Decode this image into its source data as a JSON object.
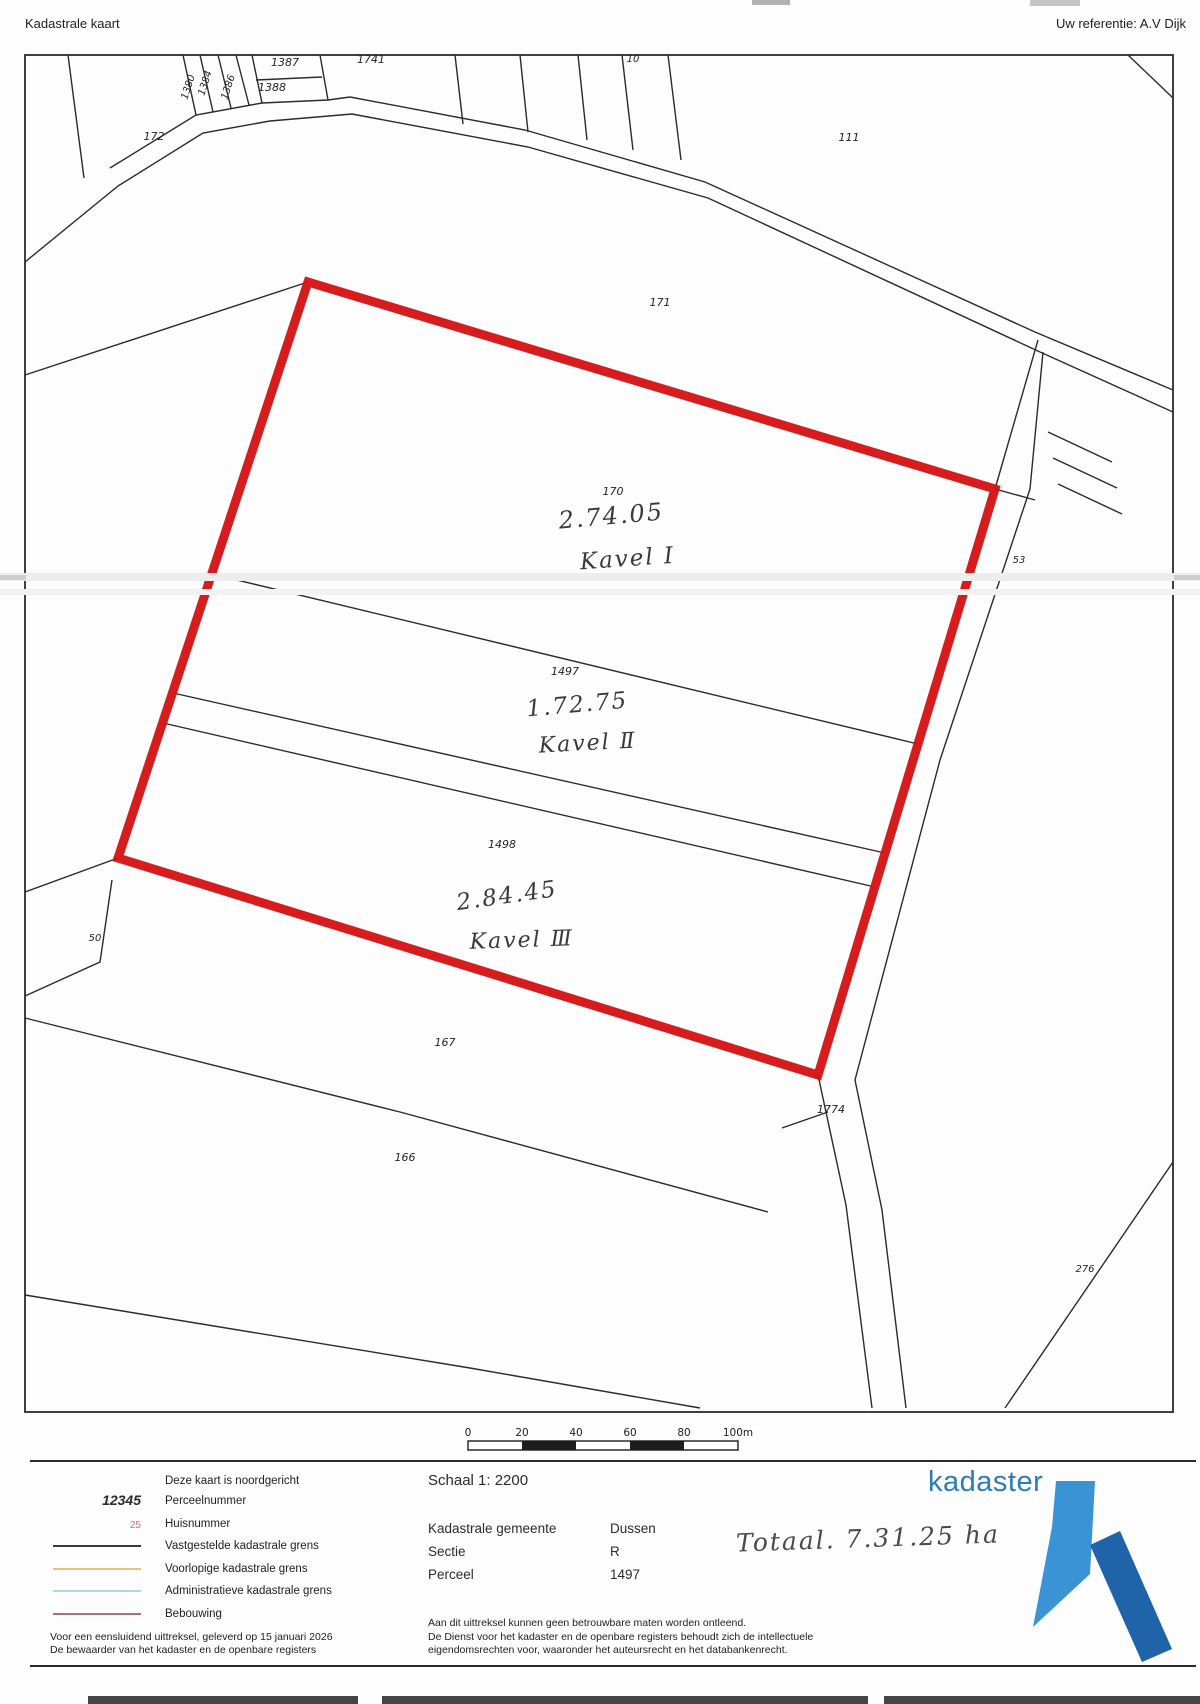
{
  "header": {
    "title": "Kadastrale kaart",
    "reference": "Uw referentie: A.V Dijk"
  },
  "map": {
    "frame": {
      "x": 25,
      "y": 55,
      "w": 1148,
      "h": 1357
    },
    "line_color": "#2b2b2b",
    "red_color": "#d41010",
    "red_outline": [
      [
        308,
        282
      ],
      [
        995,
        489
      ],
      [
        818,
        1075
      ],
      [
        118,
        858
      ]
    ],
    "lines": [
      [
        [
          68,
          55
        ],
        [
          84,
          178
        ]
      ],
      [
        [
          183,
          55
        ],
        [
          196,
          115
        ]
      ],
      [
        [
          200,
          55
        ],
        [
          213,
          112
        ]
      ],
      [
        [
          218,
          55
        ],
        [
          231,
          108
        ]
      ],
      [
        [
          236,
          55
        ],
        [
          249,
          105
        ]
      ],
      [
        [
          252,
          55
        ],
        [
          262,
          103
        ]
      ],
      [
        [
          320,
          55
        ],
        [
          328,
          100
        ]
      ],
      [
        [
          256,
          80
        ],
        [
          322,
          77
        ]
      ],
      [
        [
          110,
          168
        ],
        [
          196,
          115
        ],
        [
          262,
          103
        ],
        [
          328,
          100
        ],
        [
          350,
          97
        ]
      ],
      [
        [
          455,
          55
        ],
        [
          463,
          124
        ]
      ],
      [
        [
          520,
          55
        ],
        [
          528,
          132
        ]
      ],
      [
        [
          578,
          55
        ],
        [
          587,
          140
        ]
      ],
      [
        [
          622,
          55
        ],
        [
          633,
          150
        ]
      ],
      [
        [
          668,
          55
        ],
        [
          681,
          160
        ]
      ],
      [
        [
          350,
          97
        ],
        [
          525,
          130
        ],
        [
          705,
          182
        ],
        [
          1035,
          332
        ]
      ],
      [
        [
          118,
          186
        ],
        [
          203,
          133
        ],
        [
          270,
          121
        ],
        [
          352,
          114
        ],
        [
          528,
          147
        ],
        [
          708,
          198
        ],
        [
          1040,
          352
        ]
      ],
      [
        [
          25,
          262
        ],
        [
          118,
          186
        ]
      ],
      [
        [
          25,
          375
        ],
        [
          308,
          282
        ]
      ],
      [
        [
          1038,
          340
        ],
        [
          995,
          489
        ]
      ],
      [
        [
          995,
          489
        ],
        [
          1035,
          500
        ]
      ],
      [
        [
          212,
          574
        ],
        [
          918,
          744
        ]
      ],
      [
        [
          173,
          693
        ],
        [
          885,
          853
        ]
      ],
      [
        [
          163,
          723
        ],
        [
          875,
          887
        ]
      ],
      [
        [
          118,
          858
        ],
        [
          25,
          892
        ]
      ],
      [
        [
          112,
          880
        ],
        [
          100,
          962
        ],
        [
          25,
          996
        ]
      ],
      [
        [
          25,
          1018
        ],
        [
          400,
          1112
        ],
        [
          768,
          1212
        ]
      ],
      [
        [
          25,
          1295
        ],
        [
          470,
          1368
        ],
        [
          700,
          1408
        ]
      ],
      [
        [
          818,
          1075
        ],
        [
          846,
          1205
        ],
        [
          872,
          1408
        ]
      ],
      [
        [
          1043,
          352
        ],
        [
          1030,
          489
        ],
        [
          940,
          760
        ],
        [
          855,
          1080
        ],
        [
          882,
          1210
        ],
        [
          906,
          1408
        ]
      ],
      [
        [
          782,
          1128
        ],
        [
          828,
          1112
        ]
      ],
      [
        [
          1173,
          1162
        ],
        [
          1005,
          1408
        ]
      ],
      [
        [
          1035,
          332
        ],
        [
          1173,
          390
        ]
      ],
      [
        [
          1040,
          352
        ],
        [
          1173,
          412
        ]
      ],
      [
        [
          1048,
          432
        ],
        [
          1112,
          462
        ]
      ],
      [
        [
          1053,
          458
        ],
        [
          1117,
          488
        ]
      ],
      [
        [
          1058,
          484
        ],
        [
          1122,
          514
        ]
      ],
      [
        [
          1128,
          55
        ],
        [
          1173,
          98
        ]
      ]
    ],
    "parcel_labels": [
      {
        "t": "1380",
        "x": 191,
        "y": 88,
        "r": -72,
        "s": 10
      },
      {
        "t": "1384",
        "x": 208,
        "y": 84,
        "r": -72,
        "s": 10
      },
      {
        "t": "1386",
        "x": 231,
        "y": 88,
        "r": -72,
        "s": 10
      },
      {
        "t": "1387",
        "x": 285,
        "y": 66,
        "r": 0,
        "s": 11
      },
      {
        "t": "1388",
        "x": 272,
        "y": 91,
        "r": 0,
        "s": 11
      },
      {
        "t": "1741",
        "x": 371,
        "y": 63,
        "r": 0,
        "s": 11
      },
      {
        "t": "10",
        "x": 633,
        "y": 62,
        "r": 0,
        "s": 10
      },
      {
        "t": "172",
        "x": 154,
        "y": 140,
        "r": 0,
        "s": 11
      },
      {
        "t": "111",
        "x": 849,
        "y": 141,
        "r": 0,
        "s": 11
      },
      {
        "t": "171",
        "x": 660,
        "y": 306,
        "r": 0,
        "s": 11
      },
      {
        "t": "170",
        "x": 613,
        "y": 495,
        "r": 0,
        "s": 11
      },
      {
        "t": "1497",
        "x": 565,
        "y": 675,
        "r": 0,
        "s": 11
      },
      {
        "t": "1498",
        "x": 502,
        "y": 848,
        "r": 0,
        "s": 11
      },
      {
        "t": "167",
        "x": 445,
        "y": 1046,
        "r": 0,
        "s": 11
      },
      {
        "t": "166",
        "x": 405,
        "y": 1161,
        "r": 0,
        "s": 11
      },
      {
        "t": "1774",
        "x": 831,
        "y": 1113,
        "r": 0,
        "s": 11
      },
      {
        "t": "50",
        "x": 95,
        "y": 941,
        "r": 0,
        "s": 10
      },
      {
        "t": "53",
        "x": 1019,
        "y": 563,
        "r": 0,
        "s": 10
      },
      {
        "t": "276",
        "x": 1085,
        "y": 1272,
        "r": 0,
        "s": 10
      }
    ],
    "annotations": [
      {
        "t": "2.74.05",
        "x": 612,
        "y": 524,
        "s": 24,
        "r": -5
      },
      {
        "t": "Kavel Ⅰ",
        "x": 628,
        "y": 566,
        "s": 23,
        "r": -4
      },
      {
        "t": "1.72.75",
        "x": 578,
        "y": 712,
        "s": 23,
        "r": -5
      },
      {
        "t": "Kavel Ⅱ",
        "x": 588,
        "y": 750,
        "s": 22,
        "r": -3
      },
      {
        "t": "2.84.45",
        "x": 508,
        "y": 903,
        "s": 23,
        "r": -8
      },
      {
        "t": "Kavel Ⅲ",
        "x": 522,
        "y": 947,
        "s": 22,
        "r": -2
      }
    ]
  },
  "scale_bar": {
    "x": 468,
    "y": 1441,
    "seg_w": 54,
    "h": 9,
    "ticks": [
      "0",
      "20",
      "40",
      "60",
      "80",
      "100m"
    ],
    "dark_segments": [
      1,
      3
    ]
  },
  "footer": {
    "north_note": "Deze kaart is noordgericht",
    "legend": [
      {
        "type": "text",
        "sample": "12345",
        "label": "Perceelnummer"
      },
      {
        "type": "text",
        "sample": "25",
        "label": "Huisnummer"
      },
      {
        "type": "line",
        "color": "#3a3a3a",
        "label": "Vastgestelde kadastrale grens"
      },
      {
        "type": "line",
        "color": "#e5c37f",
        "label": "Voorlopige kadastrale grens"
      },
      {
        "type": "line",
        "color": "#aed9e4",
        "label": "Administratieve kadastrale grens"
      },
      {
        "type": "line",
        "color": "#b06d79",
        "label": "Bebouwing"
      }
    ],
    "certify": [
      "Voor een eensluidend uittreksel, geleverd op 15 januari 2026",
      "De bewaarder van het kadaster en de openbare registers"
    ],
    "schaal": "Schaal 1: 2200",
    "fields": [
      {
        "label": "Kadastrale gemeente",
        "value": "Dussen"
      },
      {
        "label": "Sectie",
        "value": "R"
      },
      {
        "label": "Perceel",
        "value": "1497"
      }
    ],
    "disclaimer": [
      "Aan dit uittreksel kunnen geen betrouwbare maten worden ontleend.",
      "De Dienst voor het kadaster en de openbare registers behoudt zich de intellectuele",
      "eigendomsrechten voor, waaronder het auteursrecht en het databankenrecht."
    ],
    "total_note": "Totaal. 7.31.25 ha",
    "logo": {
      "text": "kadaster",
      "text_color": "#2b7cb9",
      "light_color": "#3a93d5",
      "dark_color": "#1f63a8"
    }
  }
}
